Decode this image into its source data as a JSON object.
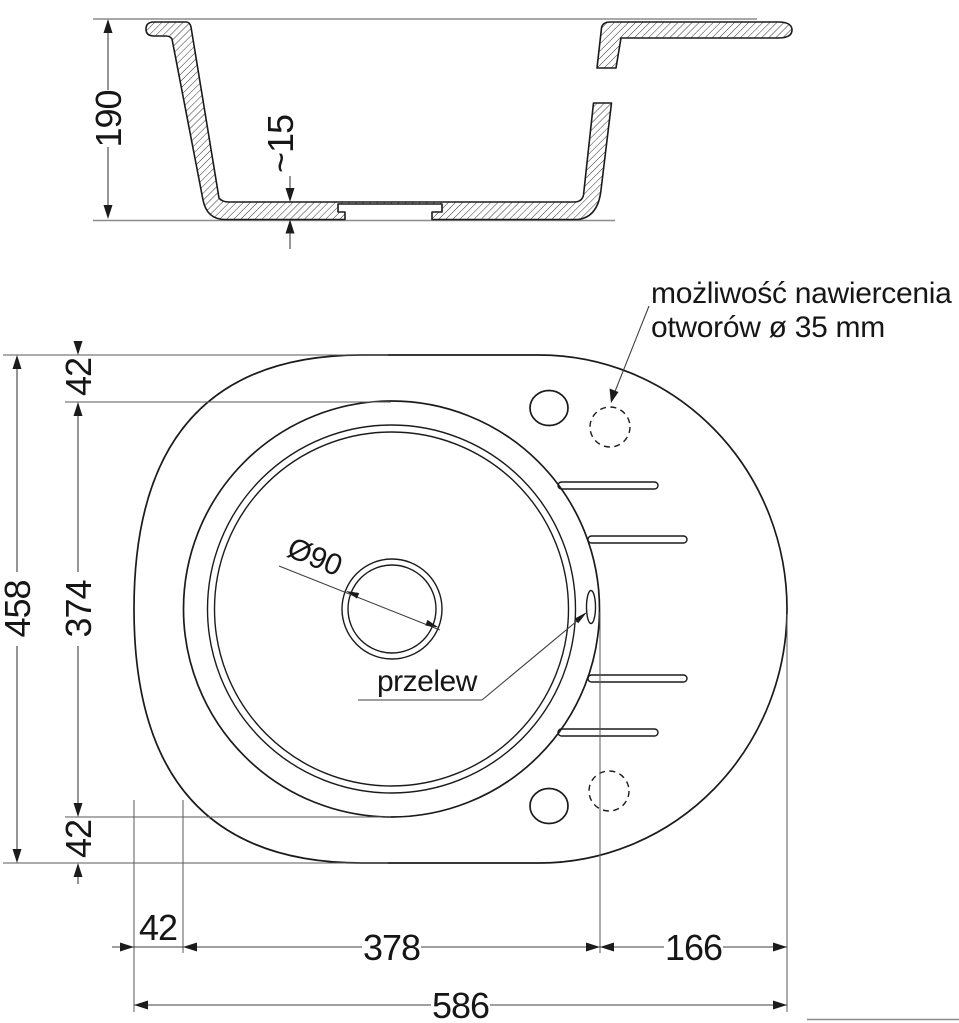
{
  "section_view": {
    "depth": "190",
    "bottom_thickness": "~15"
  },
  "top_view": {
    "annotation": {
      "line1": "możliwość nawiercenia",
      "line2": "otworów ø 35 mm"
    },
    "overflow_label": "przelew",
    "drain_diameter": "Ø90",
    "dims": {
      "total_height": "458",
      "top_offset": "42",
      "bowl_height": "374",
      "bottom_offset": "42",
      "left_offset": "42",
      "bowl_width": "378",
      "right_section": "166",
      "total_width": "586"
    }
  },
  "colors": {
    "line": "#1b1b1b",
    "dim_line": "#3f3f3f",
    "reference_line": "#8c8c8c",
    "background": "#ffffff"
  }
}
